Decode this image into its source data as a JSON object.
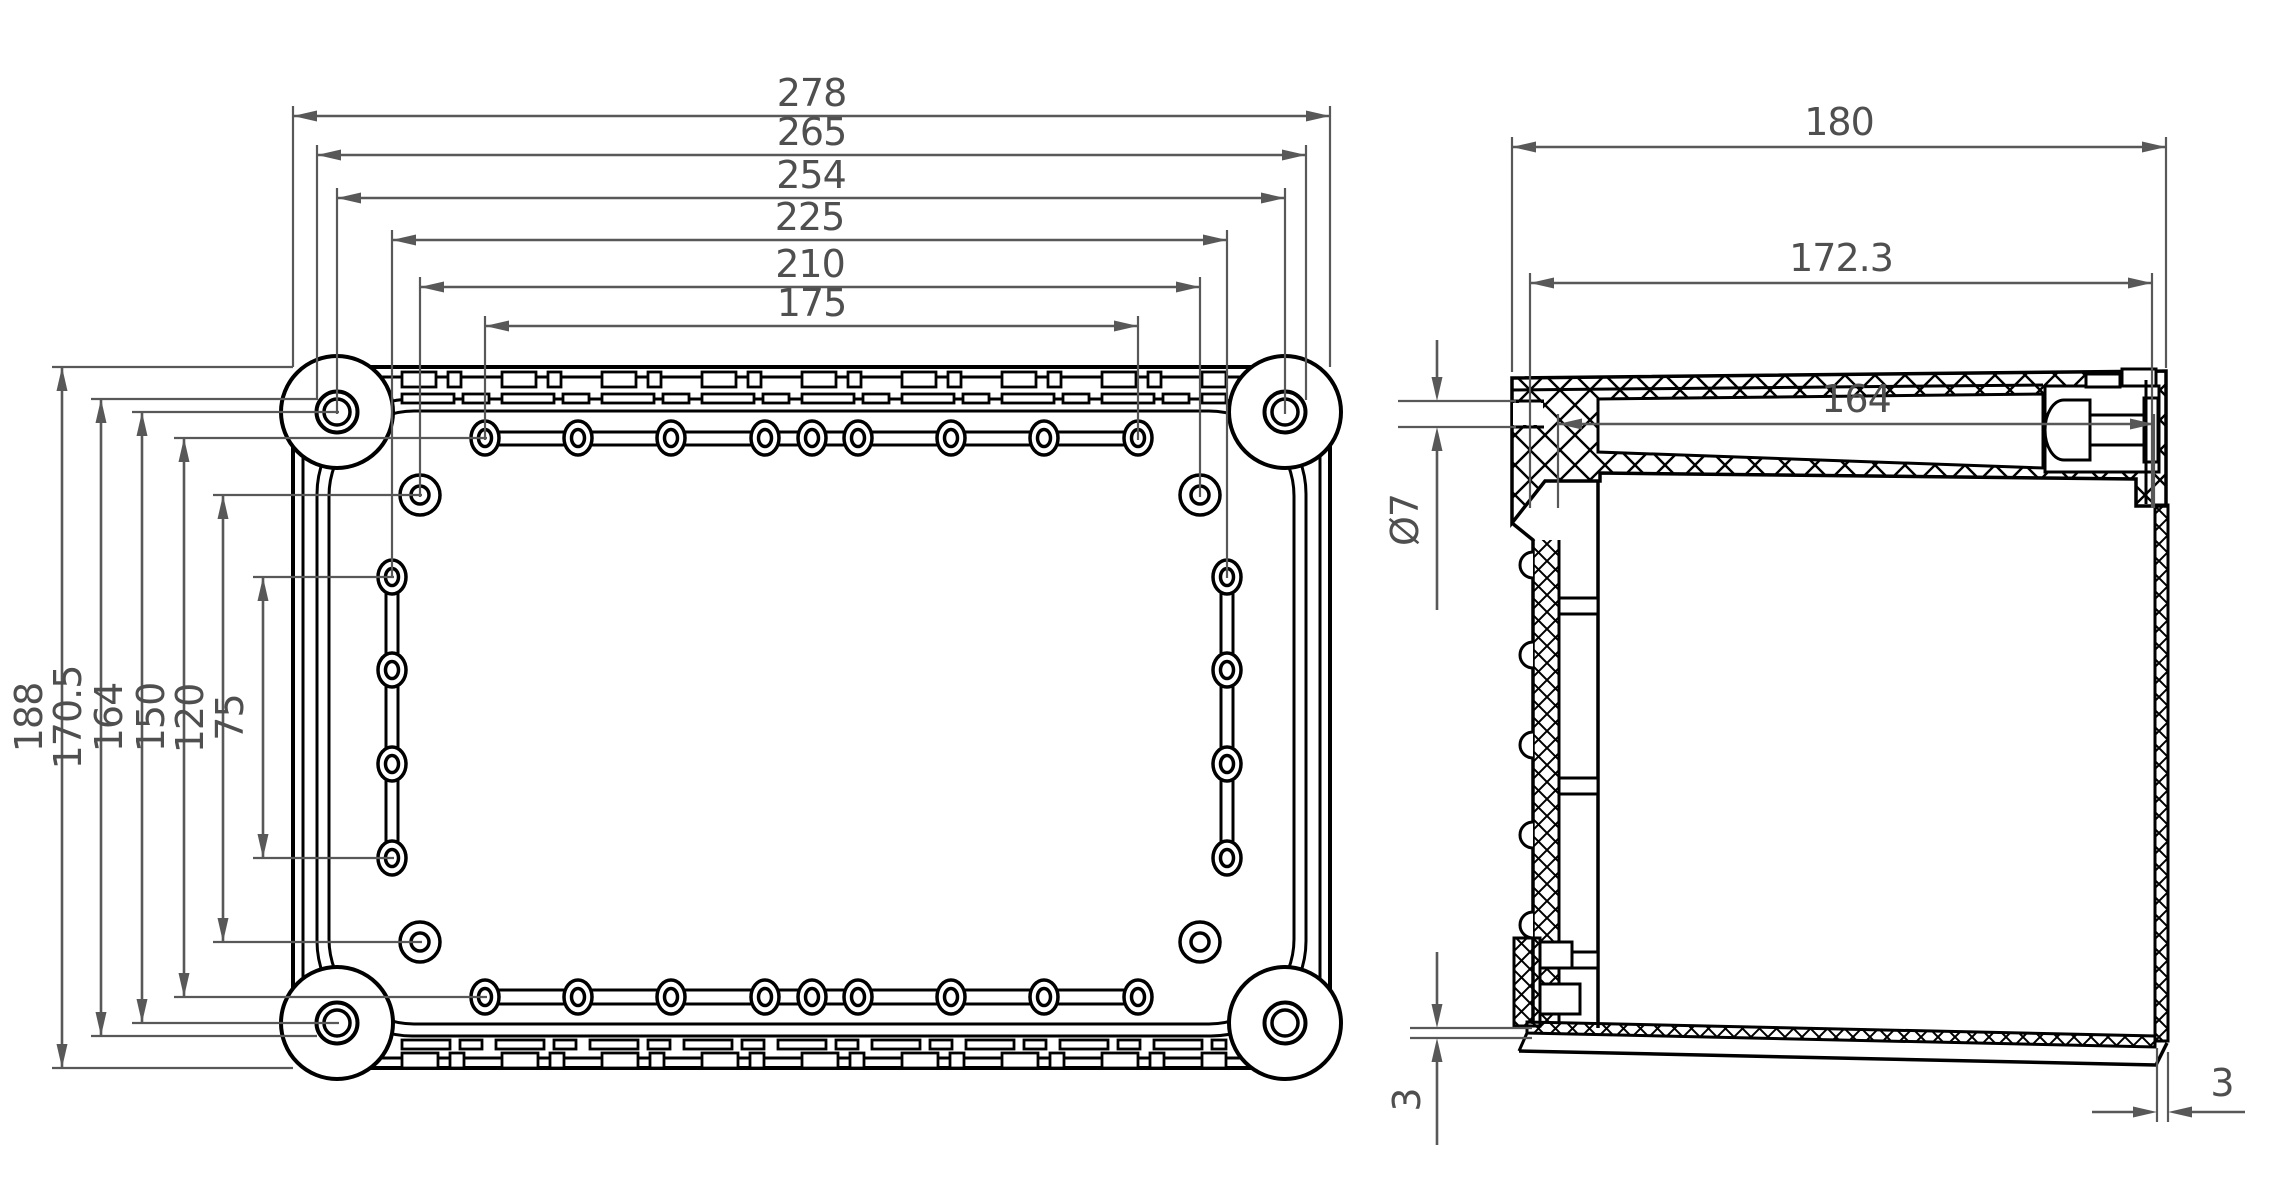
{
  "drawing_type": "technical drawing - plastic industrial enclosure",
  "views": {
    "left_view": {
      "name": "bottom interior view of enclosure base",
      "horizontal_dimensions": [
        "278",
        "265",
        "254",
        "225",
        "210",
        "175"
      ],
      "vertical_dimensions": [
        "188",
        "170.5",
        "164",
        "150",
        "120",
        "75"
      ],
      "corner_screws": 4,
      "top_row_holes": 9,
      "bottom_row_holes": 9,
      "left_column_holes": 4,
      "right_column_holes": 4,
      "corner_single_holes": 4
    },
    "right_view": {
      "name": "side section view of enclosure",
      "horizontal_dimensions": [
        "180",
        "172.3",
        "164"
      ],
      "hole_diameter_label": "Ø7",
      "wall_thickness_left": "3",
      "wall_thickness_right": "3"
    }
  },
  "colors": {
    "background": "#ffffff",
    "part_line": "#000000",
    "dimension_line": "#585858",
    "text": "#4f4f4f"
  }
}
